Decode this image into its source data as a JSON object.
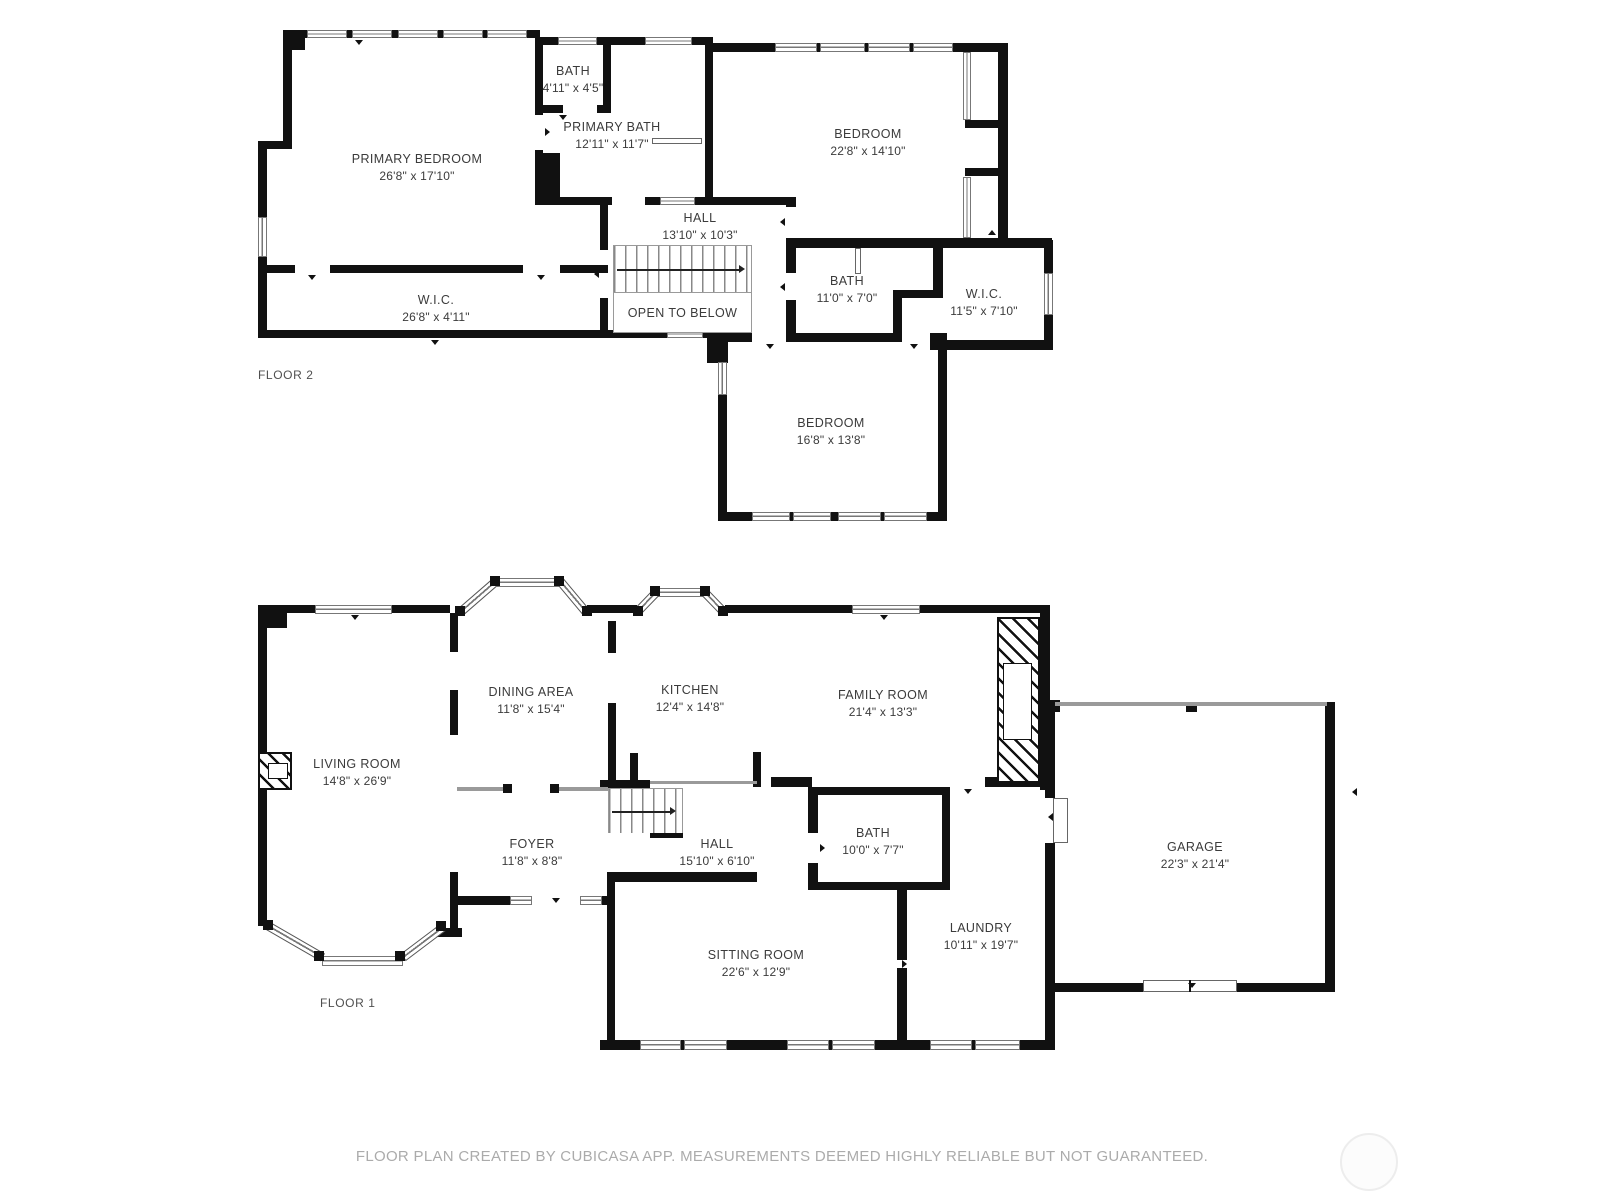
{
  "meta": {
    "footer": "FLOOR PLAN CREATED BY CUBICASA APP. MEASUREMENTS DEEMED HIGHLY RELIABLE BUT NOT GUARANTEED."
  },
  "floor2": {
    "label": "FLOOR 2",
    "open_to_below": "OPEN TO BELOW",
    "rooms": [
      {
        "name": "PRIMARY BEDROOM",
        "dims": "26'8\" x 17'10\""
      },
      {
        "name": "BATH",
        "dims": "4'11\" x 4'5\""
      },
      {
        "name": "PRIMARY BATH",
        "dims": "12'11\" x 11'7\""
      },
      {
        "name": "BEDROOM",
        "dims": "22'8\" x 14'10\""
      },
      {
        "name": "HALL",
        "dims": "13'10\" x 10'3\""
      },
      {
        "name": "W.I.C.",
        "dims": "26'8\" x 4'11\""
      },
      {
        "name": "BATH",
        "dims": "11'0\" x 7'0\""
      },
      {
        "name": "W.I.C.",
        "dims": "11'5\" x 7'10\""
      },
      {
        "name": "BEDROOM",
        "dims": "16'8\" x 13'8\""
      }
    ]
  },
  "floor1": {
    "label": "FLOOR 1",
    "rooms": [
      {
        "name": "LIVING ROOM",
        "dims": "14'8\" x 26'9\""
      },
      {
        "name": "DINING AREA",
        "dims": "11'8\" x 15'4\""
      },
      {
        "name": "KITCHEN",
        "dims": "12'4\" x 14'8\""
      },
      {
        "name": "FAMILY ROOM",
        "dims": "21'4\" x 13'3\""
      },
      {
        "name": "FOYER",
        "dims": "11'8\" x 8'8\""
      },
      {
        "name": "HALL",
        "dims": "15'10\" x 6'10\""
      },
      {
        "name": "BATH",
        "dims": "10'0\" x 7'7\""
      },
      {
        "name": "SITTING ROOM",
        "dims": "22'6\" x 12'9\""
      },
      {
        "name": "LAUNDRY",
        "dims": "10'11\" x 19'7\""
      },
      {
        "name": "GARAGE",
        "dims": "22'3\" x 21'4\""
      }
    ]
  },
  "colors": {
    "wall": "#111111",
    "room_label": "#3b3b3b",
    "floor_label": "#4f4f4f",
    "footer_text": "#ababab",
    "window_line": "#777777",
    "background": "#ffffff"
  }
}
